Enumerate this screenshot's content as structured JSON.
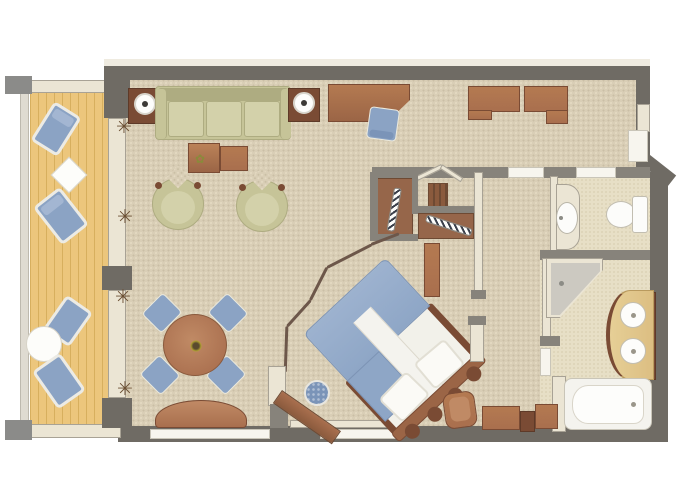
{
  "meta": {
    "title": "suite-floor-plan",
    "kind": "3d-rendered floor plan, no visible text"
  },
  "palette": {
    "wall": "#6f6b64",
    "wall2": "#87837b",
    "outer": "#efebe0",
    "cream": "#ebe5d4",
    "cream_border": "#a8a295",
    "white": "#f7f5ee",
    "fix_border": "#c9c5b8",
    "carpet": "#d9ceb6",
    "c_dark": "#cabfa5",
    "c_light": "#e4dac2",
    "bathf": "#e7dfc6",
    "bathf_d": "#d9cfb2",
    "deck": "#ecc67c",
    "deck_line": "#d7af5e",
    "wood": "#9b6546",
    "wood_dark": "#7a4b34",
    "wood_mid": "#a96f4e",
    "wood_light": "#bb8258",
    "green": "#c6c498",
    "green_dark": "#aeac81",
    "green_light": "#d3d1aa",
    "blue": "#8ba3c4",
    "blue_dark": "#7b94b8",
    "blue_light": "#a3b6d2",
    "shower": "#ccc9c1",
    "tray": "#bdbab2",
    "vanity": "#dcbe82",
    "divider": "#6d574a",
    "plant": "#6b4f33",
    "lampdot": "#3c3a36",
    "post": "#8b8b89"
  },
  "rooms": [
    {
      "name": "balcony",
      "items": [
        "lounge-chair x4",
        "square-side-table",
        "round-table",
        "railing",
        "corner-post x2"
      ]
    },
    {
      "name": "living-room",
      "items": [
        "sofa-3-seat",
        "side-table-with-lamp x2",
        "coffee-table x2",
        "tub-chair x2",
        "dining-table-round",
        "dining-chair x4",
        "bow-front-console",
        "planter x4"
      ]
    },
    {
      "name": "work-area",
      "items": [
        "desk",
        "desk-chair",
        "wall-cabinet x2"
      ]
    },
    {
      "name": "walk-in-closet",
      "items": [
        "wardrobe-with-rail x2",
        "shelf-unit"
      ]
    },
    {
      "name": "entry-hall",
      "items": [
        "entry-door"
      ]
    },
    {
      "name": "guest-toilet",
      "items": [
        "washbasin-oval",
        "toilet"
      ]
    },
    {
      "name": "bedroom",
      "items": [
        "double-bed-diagonal",
        "pillow x2",
        "scalloped-headboard",
        "ottoman-pouf",
        "tv-console-diagonal",
        "armchair",
        "dresser x3",
        "nightstand",
        "accordion-divider"
      ]
    },
    {
      "name": "bathroom",
      "items": [
        "corner-shower",
        "double-sink-vanity",
        "bathtub"
      ]
    }
  ]
}
